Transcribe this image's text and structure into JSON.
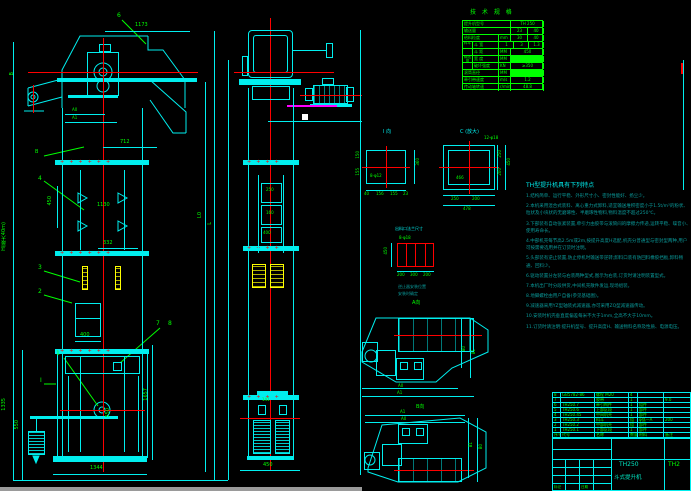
{
  "drawing": {
    "model": "TH250",
    "name": "斗式提升机",
    "drawing_no": "TH2"
  },
  "spec_table": {
    "title": "技 术 规 格",
    "model_label": "提升机型号",
    "model_value": "TH 250",
    "capacity_label": "输送量",
    "capacity_v1": "23",
    "capacity_v2": "40",
    "lump_label": "给料粒度",
    "lump_unit": "mm",
    "lump_v1": "30",
    "lump_v2": "40",
    "bucket_group": "料斗",
    "bucket_width_label": "斗 宽",
    "bw1": "1",
    "bw2": "3",
    "bw3": "1.3",
    "bucket_pitch_label": "斗 距",
    "bucket_pitch_unit": "MM",
    "bucket_pitch_value": "450",
    "belt_group": "输送带",
    "belt_width_label": "宽 度",
    "belt_width_unit": "MM",
    "belt_strength_label": "破坏强度",
    "belt_strength_unit": "KN",
    "belt_strength_value": "≥350",
    "drum_label": "滚筒直径",
    "drum_unit": "MM",
    "speed_label": "牵引带速度",
    "speed_unit": "m/s",
    "speed_value": "1.2",
    "shaft_label": "传动轴转速",
    "shaft_unit": "r/min",
    "shaft_value": "48.8"
  },
  "notes": {
    "title": "TH型提升机具有下列特点",
    "lines": [
      "1.结构简单、运行平稳、外形尺寸小、密封性能好、扬尘少。",
      "2.本机采用混合式装料、离心重力式卸料,适宜输送堆积密度小于1.5t/m³的粉状、粒状及小块状的无磨琢性、半磨琢性物料,物料温度不超过250℃。",
      "3.下部装有自动张紧装置,牵引力由胶带与滚筒间的摩擦力传递,运转平稳、噪音小、使用寿命长。",
      "4.中部机壳每节高2.5m或2m,按提升高度H选配,机壳分普通型与密封型两种,用户可按需要选用并在订货时注明。",
      "5.头部装有逆止装置,防止停机时输送带逆转;卸料口装有防回料橡胶挡板,卸料畅通、回料少。",
      "6.驱动装置分左装与右装两种型式,图示为右装,订货时请注明装置型式。",
      "7.本机出厂时分段供货,中间机壳散件发运,现场组装。",
      "8.地脚螺栓由用户自备(参见基础图)。",
      "9.减速器采用YZ型轴装式减速器,亦可采用ZQ型减速器传动。",
      "10.安装时机壳垂直度偏差每米不大于1mm,全高不大于10mm。",
      "11.订货时请注明:提升机型号、提升高度H、输送物料名称及性质、电源电压。"
    ]
  },
  "details": {
    "view_i_title": "I 向",
    "view_i_hole": "8-φ12",
    "view_c_title": "C (放大)",
    "view_c_hole": "12-φ18",
    "flange_title": "出料口法兰尺寸",
    "flange_hole": "8-φ18",
    "nonreturn_note_1": "逆止器安装位置",
    "nonreturn_note_2": "安装时确定",
    "view_a_label": "A向",
    "view_b_label": "B向"
  },
  "dims": {
    "d1173": "1173",
    "dA0": "A0",
    "dA1": "A1",
    "d712": "712",
    "d450": "450",
    "d1130": "1130",
    "d332": "332",
    "d400": "400",
    "dH": "H(最大40m)",
    "dL0": "L0",
    "dL": "L",
    "d1335": "1335",
    "d550a": "550",
    "d1657": "1657",
    "d550b": "550",
    "d1344": "1344",
    "m250": "250",
    "m160": "160",
    "m400": "400",
    "m141": "141",
    "m450": "450",
    "i360": "360",
    "i150": "150",
    "i155": "155",
    "ib1": "40",
    "ib2": "156",
    "ib3": "155",
    "ib4": "23",
    "c466": "466",
    "cr1": "250",
    "cr2": "200",
    "cr3": "450",
    "cb1": "250",
    "cb2": "200",
    "cb3": "478",
    "f450": "450",
    "fb1": "200",
    "fb2": "300",
    "fb3": "200",
    "pB0": "B0",
    "pB1": "B1",
    "pA0": "A0",
    "pA1": "A1"
  },
  "items": {
    "i1": "1",
    "i2": "2",
    "i3": "3",
    "i4": "4",
    "i6": "6",
    "i7": "7",
    "i8": "8",
    "secB": "B",
    "secI": "I",
    "topB": "B"
  },
  "bom": {
    "headers": [
      "序号",
      "代号",
      "名称",
      "数量",
      "材料",
      "备注"
    ],
    "rows": [
      {
        "no": "8",
        "code": "GB5782-86",
        "name": "螺栓 M20",
        "qty": "4",
        "mat": "",
        "rem": ""
      },
      {
        "no": "7",
        "code": "",
        "name": "胶带",
        "qty": "1",
        "mat": "",
        "rem": "9.0"
      },
      {
        "no": "6",
        "code": "TH250.7",
        "name": "牵引构件",
        "qty": "1",
        "mat": "组件",
        "rem": ""
      },
      {
        "no": "5",
        "code": "TH250.6",
        "name": "上部区段",
        "qty": "1",
        "mat": "部件",
        "rem": ""
      },
      {
        "no": "4",
        "code": "TH250.45",
        "name": "中间机壳",
        "qty": "1",
        "mat": "部件",
        "rem": ""
      },
      {
        "no": "3",
        "code": "TH250.3",
        "name": "料斗",
        "qty": "组",
        "mat": "φ弧—A",
        "rem": "200"
      },
      {
        "no": "2",
        "code": "TH250.2",
        "name": "中部机壳",
        "qty": "组",
        "mat": "部件",
        "rem": ""
      },
      {
        "no": "1",
        "code": "TH250.1",
        "name": "下部区段",
        "qty": "1",
        "mat": "部件",
        "rem": ""
      }
    ]
  },
  "title_block": {
    "model": "TH250",
    "name": "斗式提升机",
    "drawing_no": "TH2",
    "rev_label": "标记",
    "date_label": "日期"
  }
}
